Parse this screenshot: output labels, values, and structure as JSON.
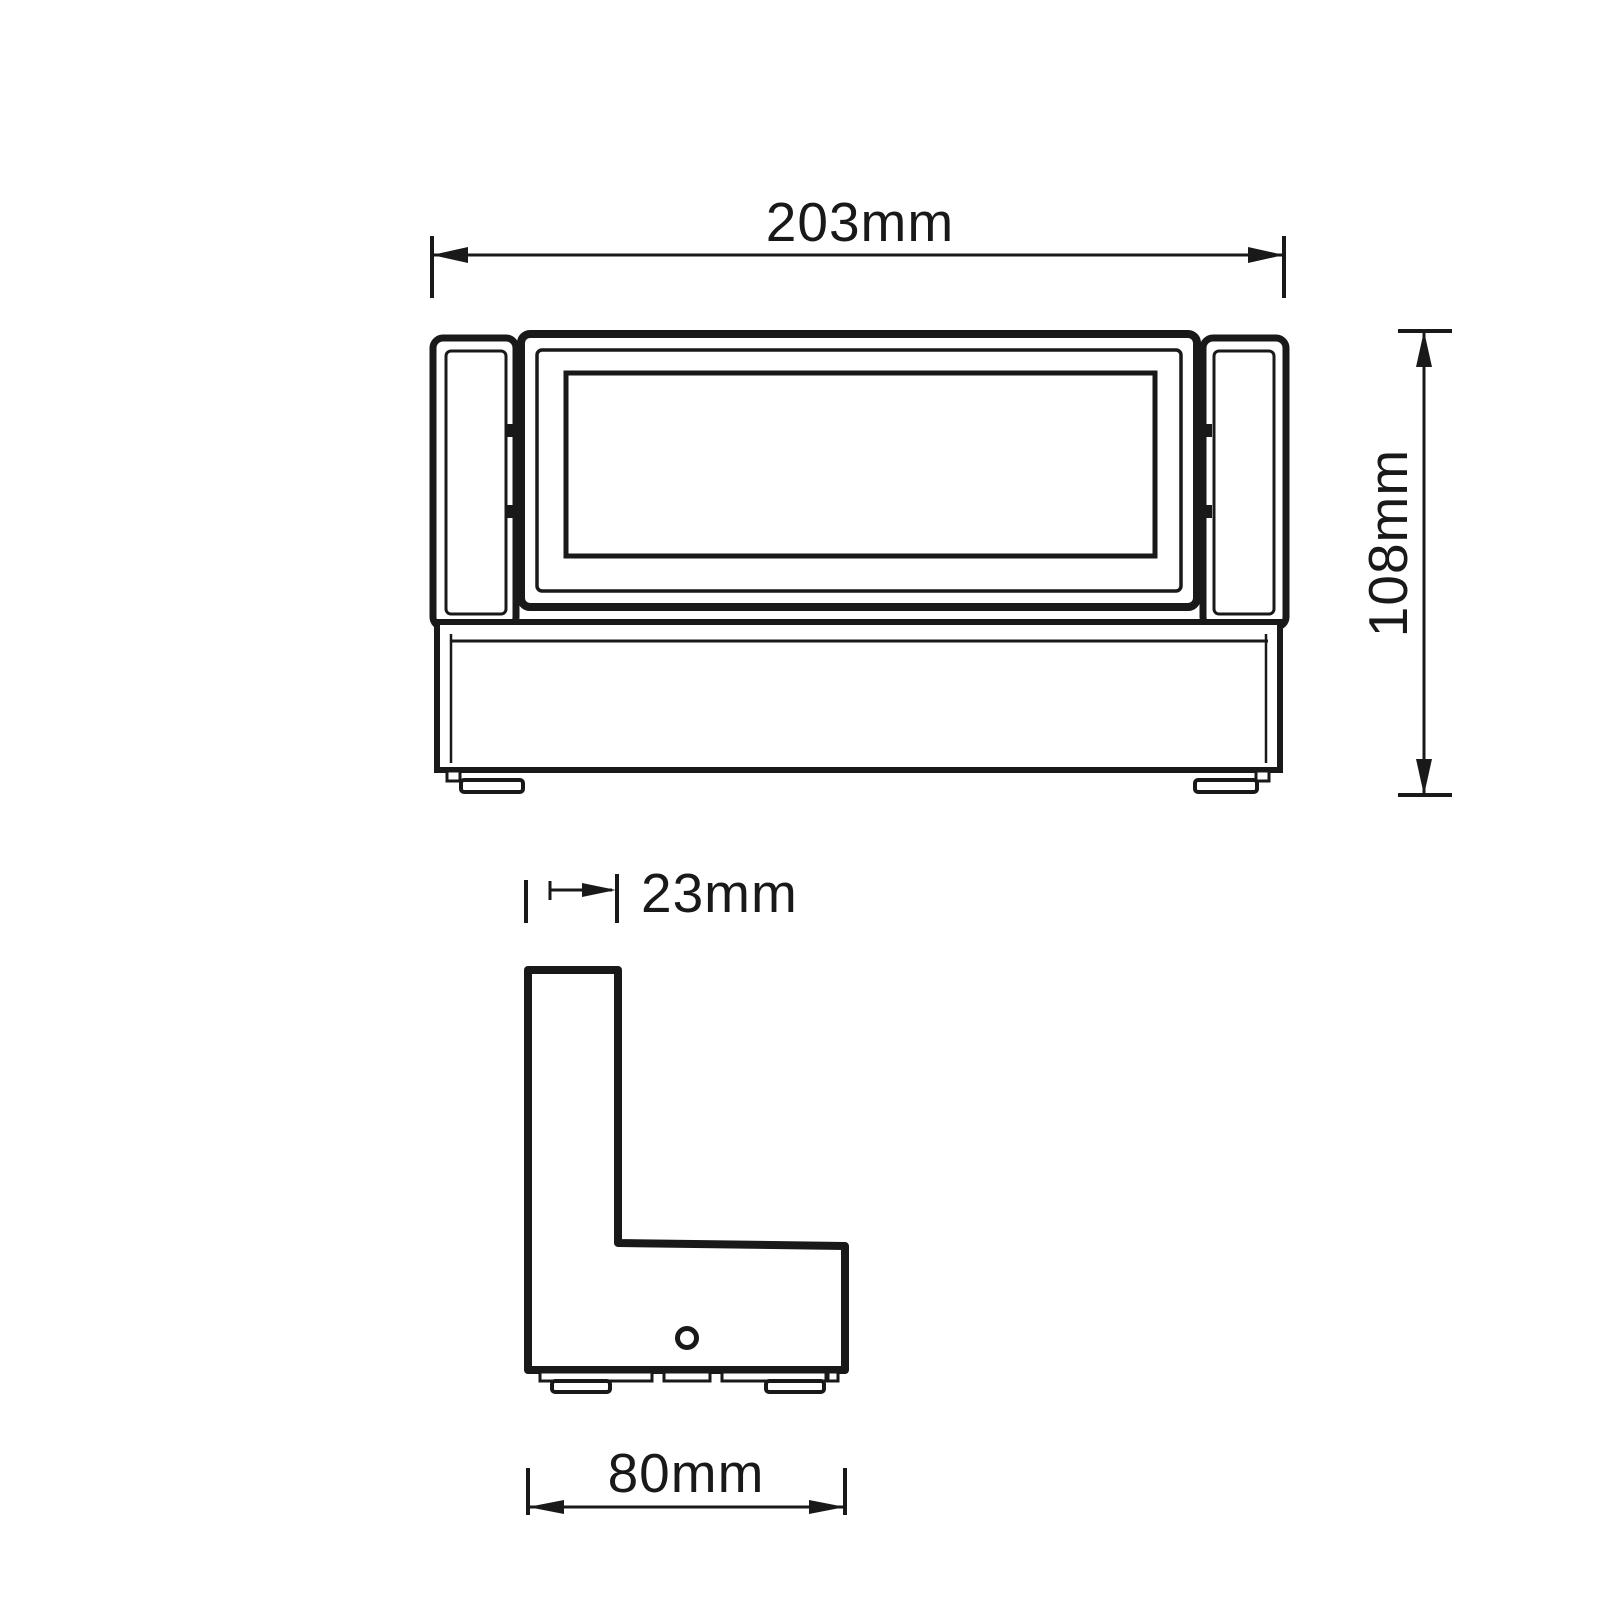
{
  "drawing": {
    "background_color": "#ffffff",
    "line_color": "#191919",
    "dimensions": {
      "overall_width": {
        "label": "203mm"
      },
      "overall_height": {
        "label": "108mm"
      },
      "bracket_depth": {
        "label": "23mm"
      },
      "base_depth": {
        "label": "80mm"
      }
    }
  }
}
